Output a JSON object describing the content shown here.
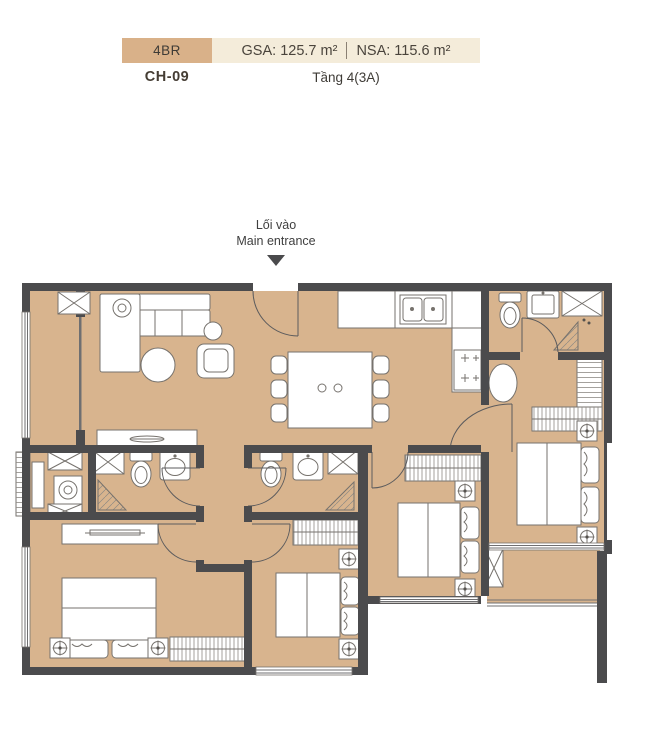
{
  "header": {
    "unit_type": "4BR",
    "unit_code": "CH-09",
    "gsa": "GSA: 125.7 m²",
    "nsa": "NSA: 115.6 m²",
    "floor_label": "Tầng 4(3A)",
    "colors": {
      "unit_type_bg": "#d9b189",
      "area_bg": "#f4ecda",
      "text": "#43403b"
    }
  },
  "entrance": {
    "label_vi": "Lối vào",
    "label_en": "Main entrance",
    "arrow_icon": "triangle-down"
  },
  "floorplan": {
    "colors": {
      "floor": "#d8b48e",
      "wall": "#4b4b4d",
      "fixture_stroke": "#76726d"
    },
    "rooms": [
      "living-room",
      "dining-area",
      "kitchen",
      "loggia-balcony",
      "laundry-corner",
      "bathroom-1",
      "bathroom-2",
      "master-bathroom",
      "hallway",
      "corridor-lobby",
      "bedroom-1",
      "bedroom-2",
      "bedroom-3",
      "master-bedroom",
      "dressing-area",
      "balcony"
    ],
    "fixture_icons": [
      "sofa",
      "coffee-table",
      "armchair",
      "side-table",
      "console-table",
      "dining-table",
      "dining-chair",
      "kitchen-counter",
      "double-sink",
      "cooktop",
      "toilet",
      "wash-basin",
      "shower-tray",
      "oval-tub",
      "washing-machine",
      "wardrobe",
      "shelf-unit",
      "bed",
      "tv-cabinet",
      "ceiling-fan",
      "service-shaft",
      "entrance-door",
      "door-swing",
      "window",
      "ac-louver",
      "railing"
    ]
  }
}
